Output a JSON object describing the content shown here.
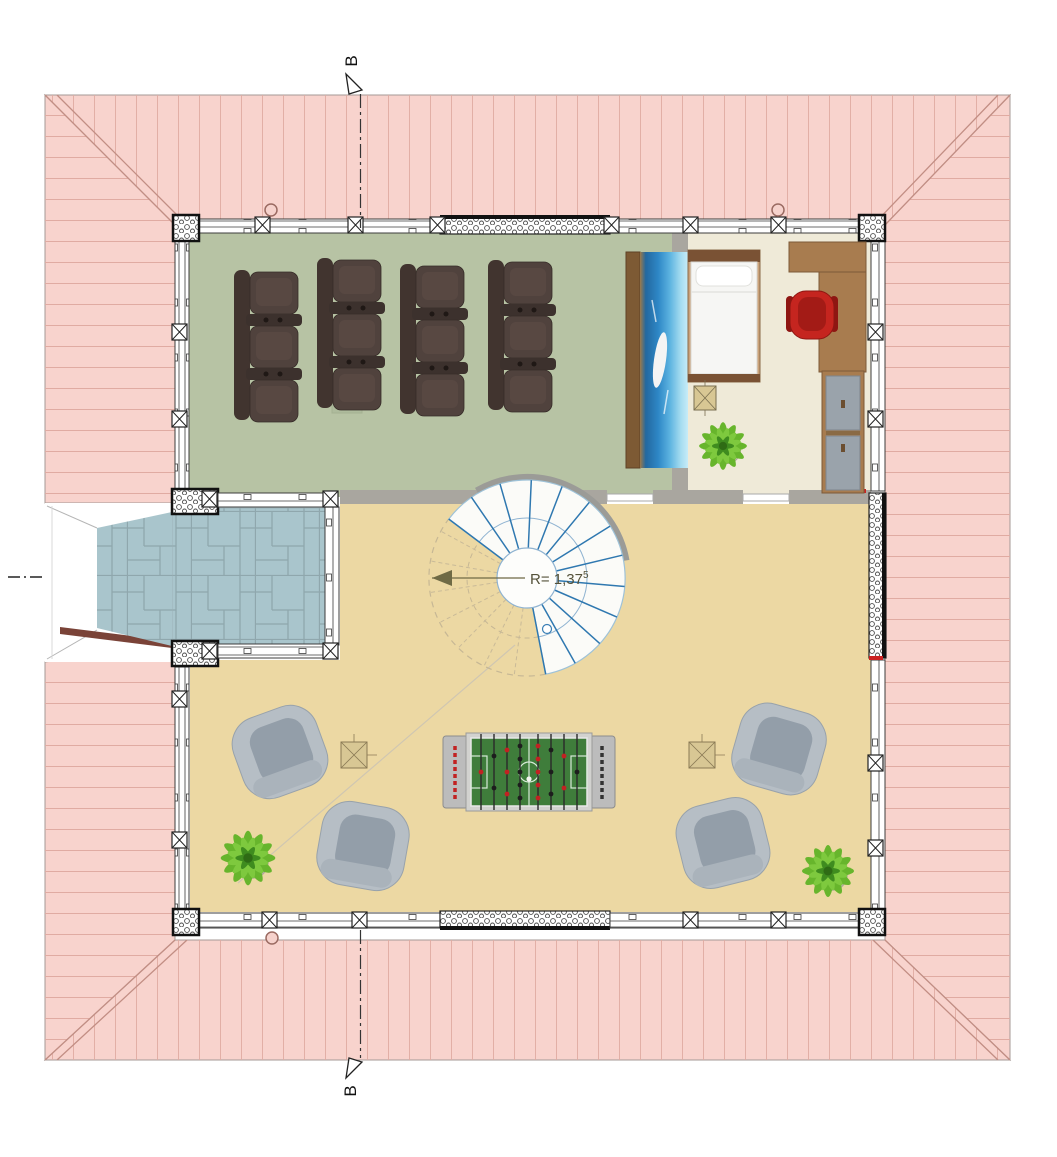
{
  "drawing": {
    "type": "architectural-floor-plan-attic-level",
    "section_markers": {
      "top_label": "B",
      "bottom_label": "B"
    },
    "stair": {
      "radius_label": "R= 1,37",
      "radius_superscript": "5"
    },
    "colors": {
      "roof": "#f8d3cd",
      "roof_lines": "#e0aba2",
      "roof_hip": "#c28e84",
      "roof_fascia_dark": "#7a4338",
      "theater_floor": "#b7c3a4",
      "bedroom_floor": "#efead8",
      "gameroom_floor": "#ecd8a3",
      "balcony_tiles": "#a9c5cc",
      "interior_wall": "#a9a69f",
      "stair_tread_blue": "#2f78b0",
      "stair_dashed": "#c6b795",
      "dimension_olive": "#6f6a45",
      "sofa_brown": "#4e403c",
      "armchair_gray": "#b6bec5",
      "desk_wood": "#a87c4f",
      "chair_red": "#c5251f",
      "plant_green": "#67b52c",
      "foosball_green": "#3f7d3b",
      "screen_sea_blue": "#2e87c6"
    }
  }
}
